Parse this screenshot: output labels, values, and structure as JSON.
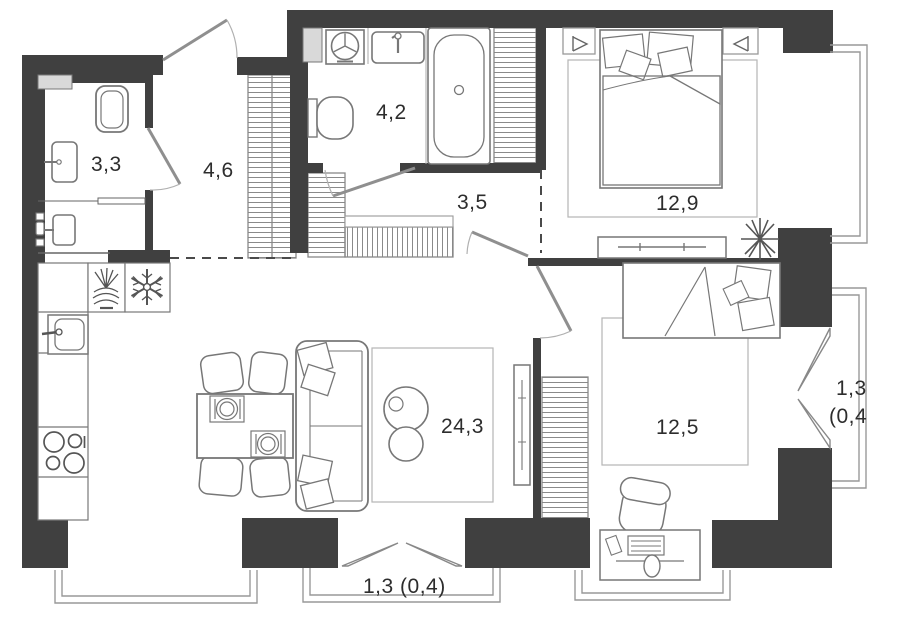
{
  "plan": {
    "type": "apartment-floor-plan",
    "units": "square-meters-with-comma-decimal",
    "rooms": [
      {
        "id": "bathroom-guest",
        "area": "3,3"
      },
      {
        "id": "hallway",
        "area": "4,6"
      },
      {
        "id": "bathroom-main",
        "area": "4,2"
      },
      {
        "id": "hall",
        "area": "3,5"
      },
      {
        "id": "bedroom-master",
        "area": "12,9"
      },
      {
        "id": "kitchen-living-room",
        "area": "24,3"
      },
      {
        "id": "bedroom-second",
        "area": "12,5"
      }
    ],
    "balconies": [
      {
        "id": "side-balcony",
        "label_line1": "1,3",
        "label_line2": "(0,4"
      },
      {
        "id": "bottom-balcony",
        "label": "1,3 (0,4)"
      }
    ],
    "fixtures": [
      "toilet",
      "washbasin",
      "bathtub",
      "washing-machine",
      "sink",
      "fridge-snowflake",
      "dish-rack",
      "stove-4-burners",
      "dining-table",
      "chairs",
      "sofa",
      "coffee-tables",
      "tv-panel",
      "double-bed",
      "single-bed",
      "dresser",
      "desk",
      "desk-chair",
      "plant",
      "wardrobe-hatched",
      "entry-door",
      "interior-doors",
      "balcony-doors"
    ],
    "colors": {
      "wall": "#404040",
      "furniture_line": "#777777",
      "shaft_fill": "#d9d9d9",
      "rug_line": "#b5b5b5",
      "background": "#ffffff"
    }
  }
}
